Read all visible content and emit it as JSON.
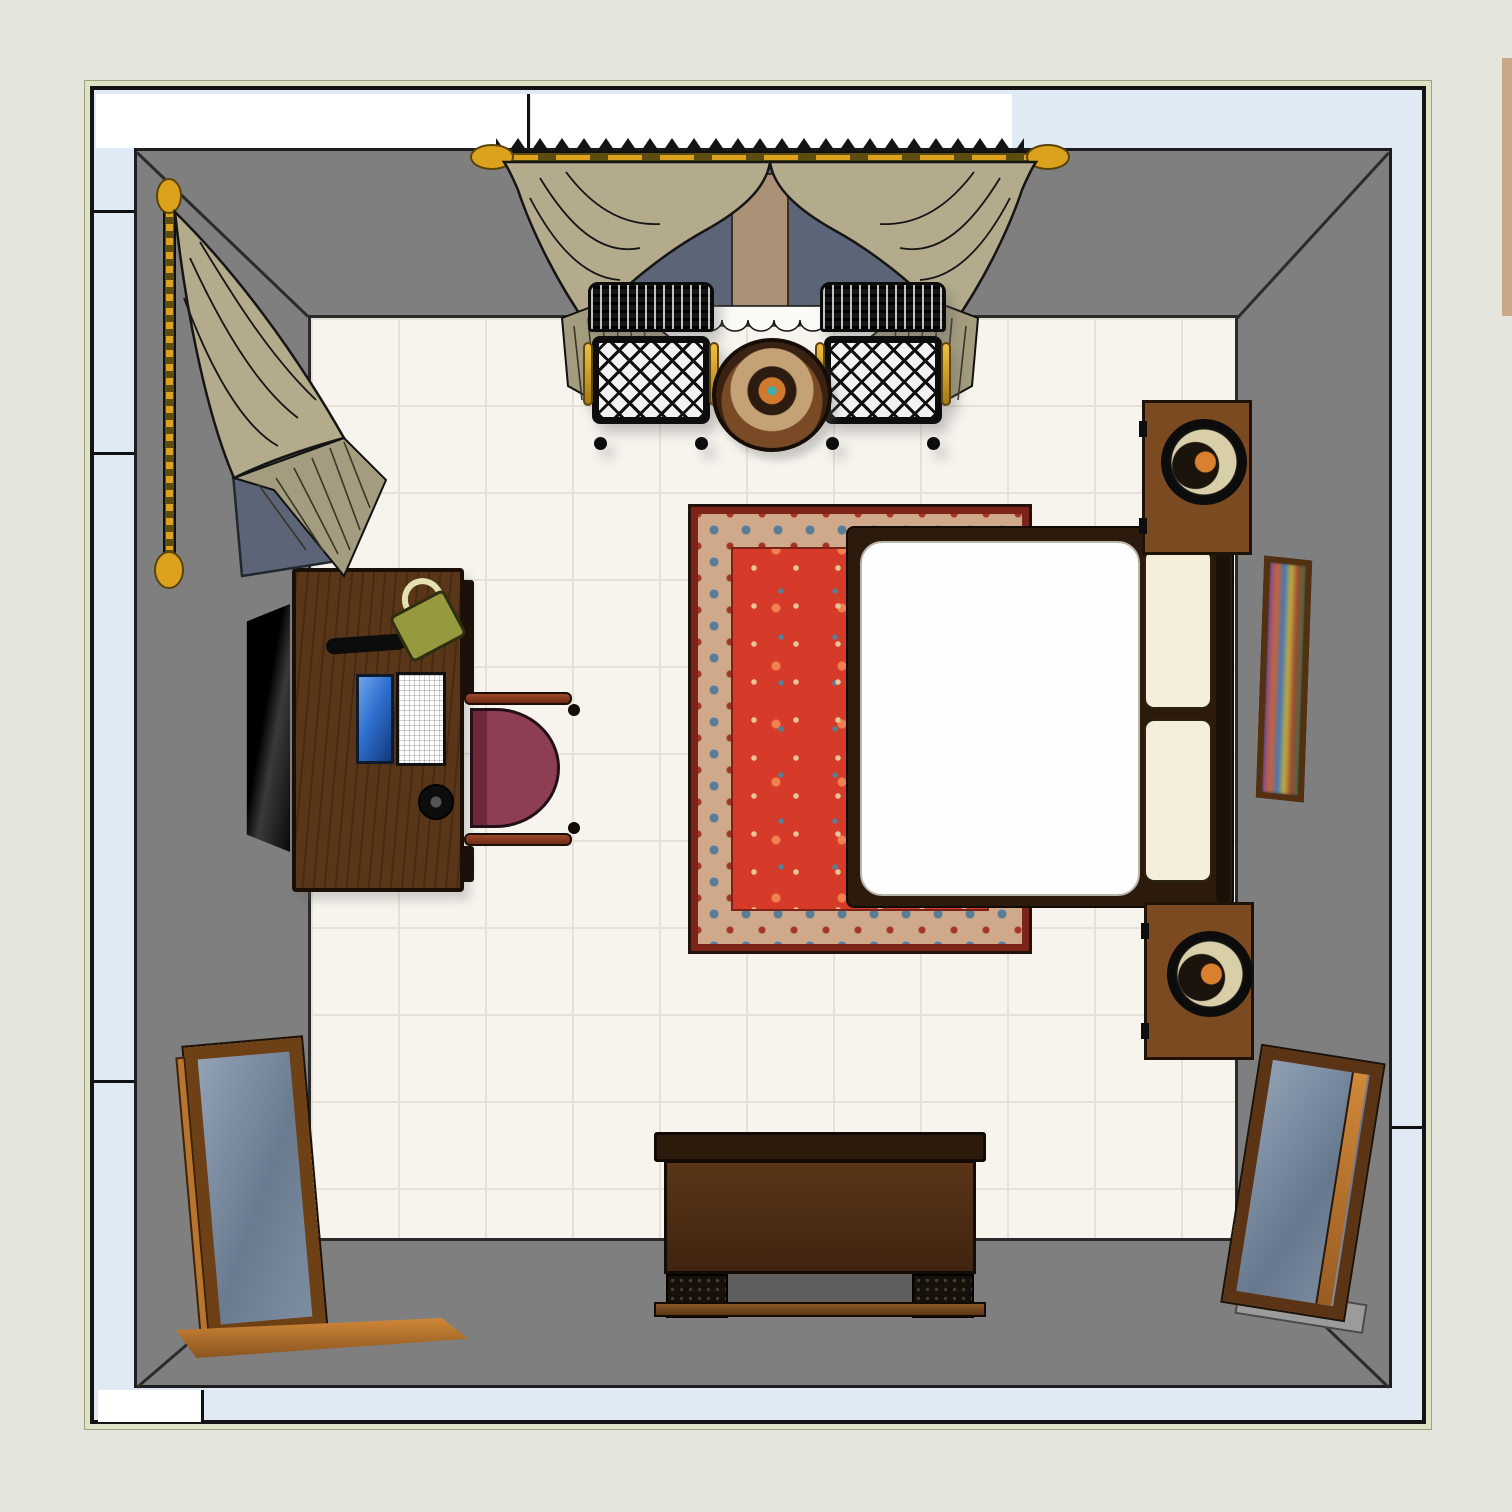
{
  "palette": {
    "bg": "#e6e5dd",
    "frame_green": "#dde3c6",
    "exterior_white": "#ffffff",
    "exterior_blue": "#dfeaf4",
    "wall_gray": "#7f7f7f",
    "floor": "#f7f4ee",
    "grout": "#e6e1d6",
    "wood_desk": "#5a3619",
    "wood_mid": "#7b4a20",
    "curtain_khaki": "#b3ab8c",
    "curtain_pleat": "#a49c7e",
    "rod_gold": "#dda21d",
    "window_view": "#5c6577",
    "window_column": "#ab9176",
    "rug_red": "#d63a28",
    "rug_border_tan": "#cfa98a",
    "rug_border_dark": "#7c241a",
    "rug_blue": "#5a7d97",
    "bed_frame": "#2c1b0d",
    "mattress": "#fefefe",
    "pillow": "#f4eeda",
    "seat_maroon": "#8e3e52",
    "lamp_cream": "#d8cfa8",
    "lamp_orange": "#d97f2e",
    "bag_olive": "#97993f",
    "stripe_tan": "#c9a887"
  },
  "scene": {
    "type": "bedroom-floor-plan-top-view",
    "items": [
      "plan-frame",
      "exterior-siding-band",
      "room-walls",
      "tile-floor",
      "top-window",
      "top-window-curtains",
      "left-window-curtain",
      "wicker-chair-left",
      "wicker-chair-right",
      "round-side-table",
      "area-rug",
      "bed",
      "pillow",
      "nightstand-top",
      "nightstand-bottom",
      "table-lamp-top",
      "table-lamp-bottom",
      "wall-art",
      "desk",
      "laptop",
      "desk-lamp",
      "handbag",
      "desk-phone",
      "desk-chair",
      "wall-tv",
      "dresser",
      "floor-mirror-left",
      "floor-mirror-base",
      "floor-mirror-right"
    ]
  }
}
